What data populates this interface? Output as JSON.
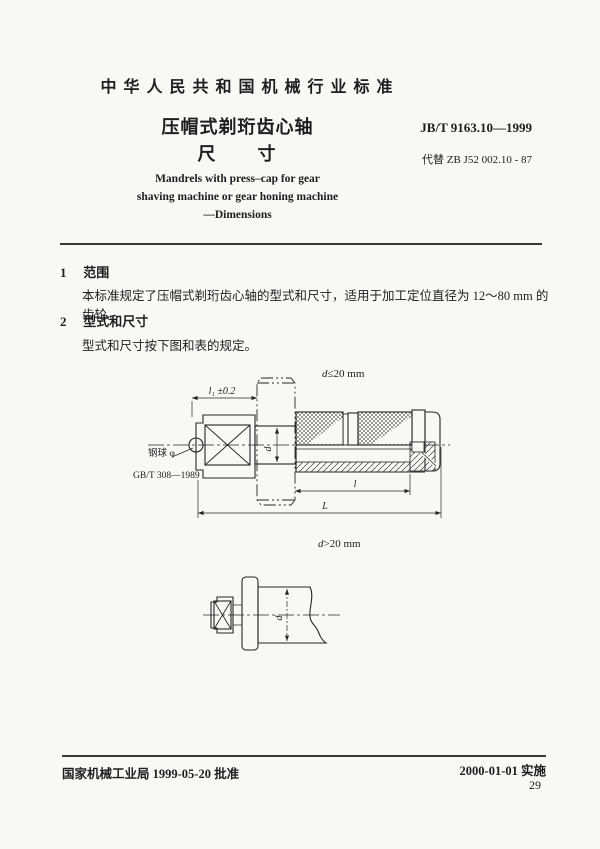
{
  "header": {
    "org_title": "中华人民共和国机械行业标准",
    "doc_title": "压帽式剃珩齿心轴",
    "doc_subtitle": "尺　　寸",
    "standard_no": "JB/T 9163.10—1999",
    "supersedes": "代替 ZB J52 002.10 - 87",
    "en_title_1": "Mandrels with press–cap for gear",
    "en_title_2": "shaving machine or gear honing machine",
    "en_title_3": "—Dimensions"
  },
  "sections": {
    "s1_no": "1",
    "s1_title": "范围",
    "s1_body": "本标准规定了压帽式剃珩齿心轴的型式和尺寸，适用于加工定位直径为 12～80 mm 的齿轮。",
    "s2_no": "2",
    "s2_title": "型式和尺寸",
    "s2_body": "型式和尺寸按下图和表的规定。"
  },
  "figure1": {
    "caption_var": "d",
    "caption_rest": "≤20 mm",
    "dim_l1": "l₁ ±0.2",
    "dim_d": "d",
    "dim_l": "l",
    "dim_L": "L",
    "ball_label": "钢球 φ",
    "ball_std": "GB/T 308—1989"
  },
  "figure2": {
    "caption_var": "d",
    "caption_rest": ">20 mm",
    "dim_d": "d"
  },
  "footer": {
    "approval": "国家机械工业局 1999-05-20 批准",
    "implementation": "2000-01-01 实施",
    "page_no": "29"
  },
  "colors": {
    "ink": "#262626",
    "paper": "#f9f8f5"
  }
}
